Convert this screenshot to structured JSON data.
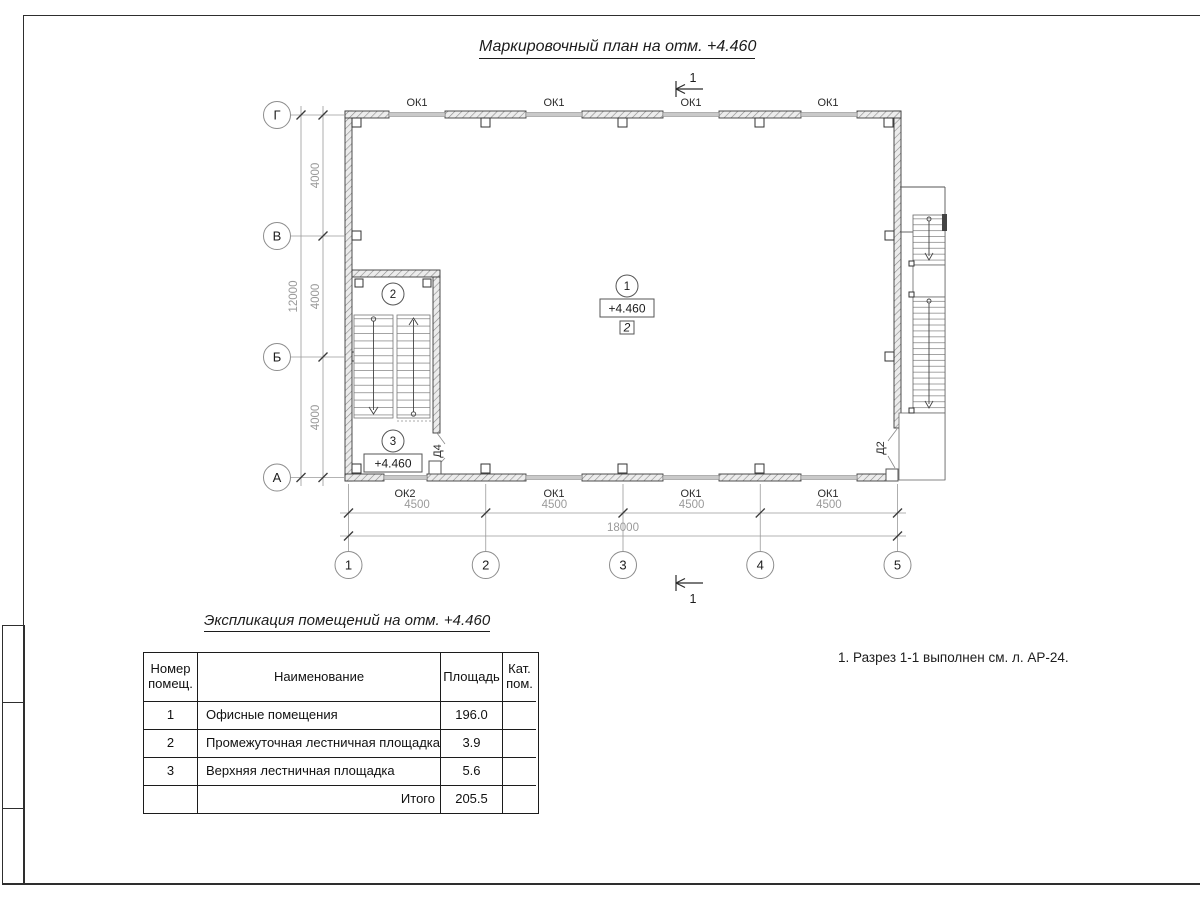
{
  "titles": {
    "plan": "Маркировочный план на отм. +4.460",
    "schedule": "Экспликация помещений на отм. +4.460"
  },
  "note": "1. Разрез 1-1 выполнен см. л. АР-24.",
  "plan": {
    "section_mark": "1",
    "grid_rows": [
      "Г",
      "В",
      "Б",
      "А"
    ],
    "grid_cols": [
      "1",
      "2",
      "3",
      "4",
      "5"
    ],
    "dims_vertical": [
      "4000",
      "4000",
      "4000"
    ],
    "dim_vertical_total": "12000",
    "dims_horizontal": [
      "4500",
      "4500",
      "4500",
      "4500"
    ],
    "dim_horizontal_total": "18000",
    "windows_top": [
      "ОК1",
      "ОК1",
      "ОК1",
      "ОК1"
    ],
    "windows_bottom": [
      "ОК2",
      "ОК1",
      "ОК1",
      "ОК1"
    ],
    "door_left": "Д4",
    "door_right": "Д2",
    "room1": {
      "num": "1",
      "elevation": "+4.460",
      "floor_type": "2"
    },
    "room2": {
      "num": "2"
    },
    "room3": {
      "num": "3",
      "elevation": "+4.460"
    }
  },
  "schedule": {
    "header": {
      "num_l1": "Номер",
      "num_l2": "помещ.",
      "name": "Наименование",
      "area": "Площадь",
      "cat_l1": "Кат.",
      "cat_l2": "пом."
    },
    "rows": [
      {
        "num": "1",
        "name": "Офисные помещения",
        "area": "196.0",
        "cat": ""
      },
      {
        "num": "2",
        "name": "Промежуточная лестничная площадка",
        "area": "3.9",
        "cat": ""
      },
      {
        "num": "3",
        "name": "Верхняя лестничная площадка",
        "area": "5.6",
        "cat": ""
      }
    ],
    "total_label": "Итого",
    "total_area": "205.5"
  }
}
